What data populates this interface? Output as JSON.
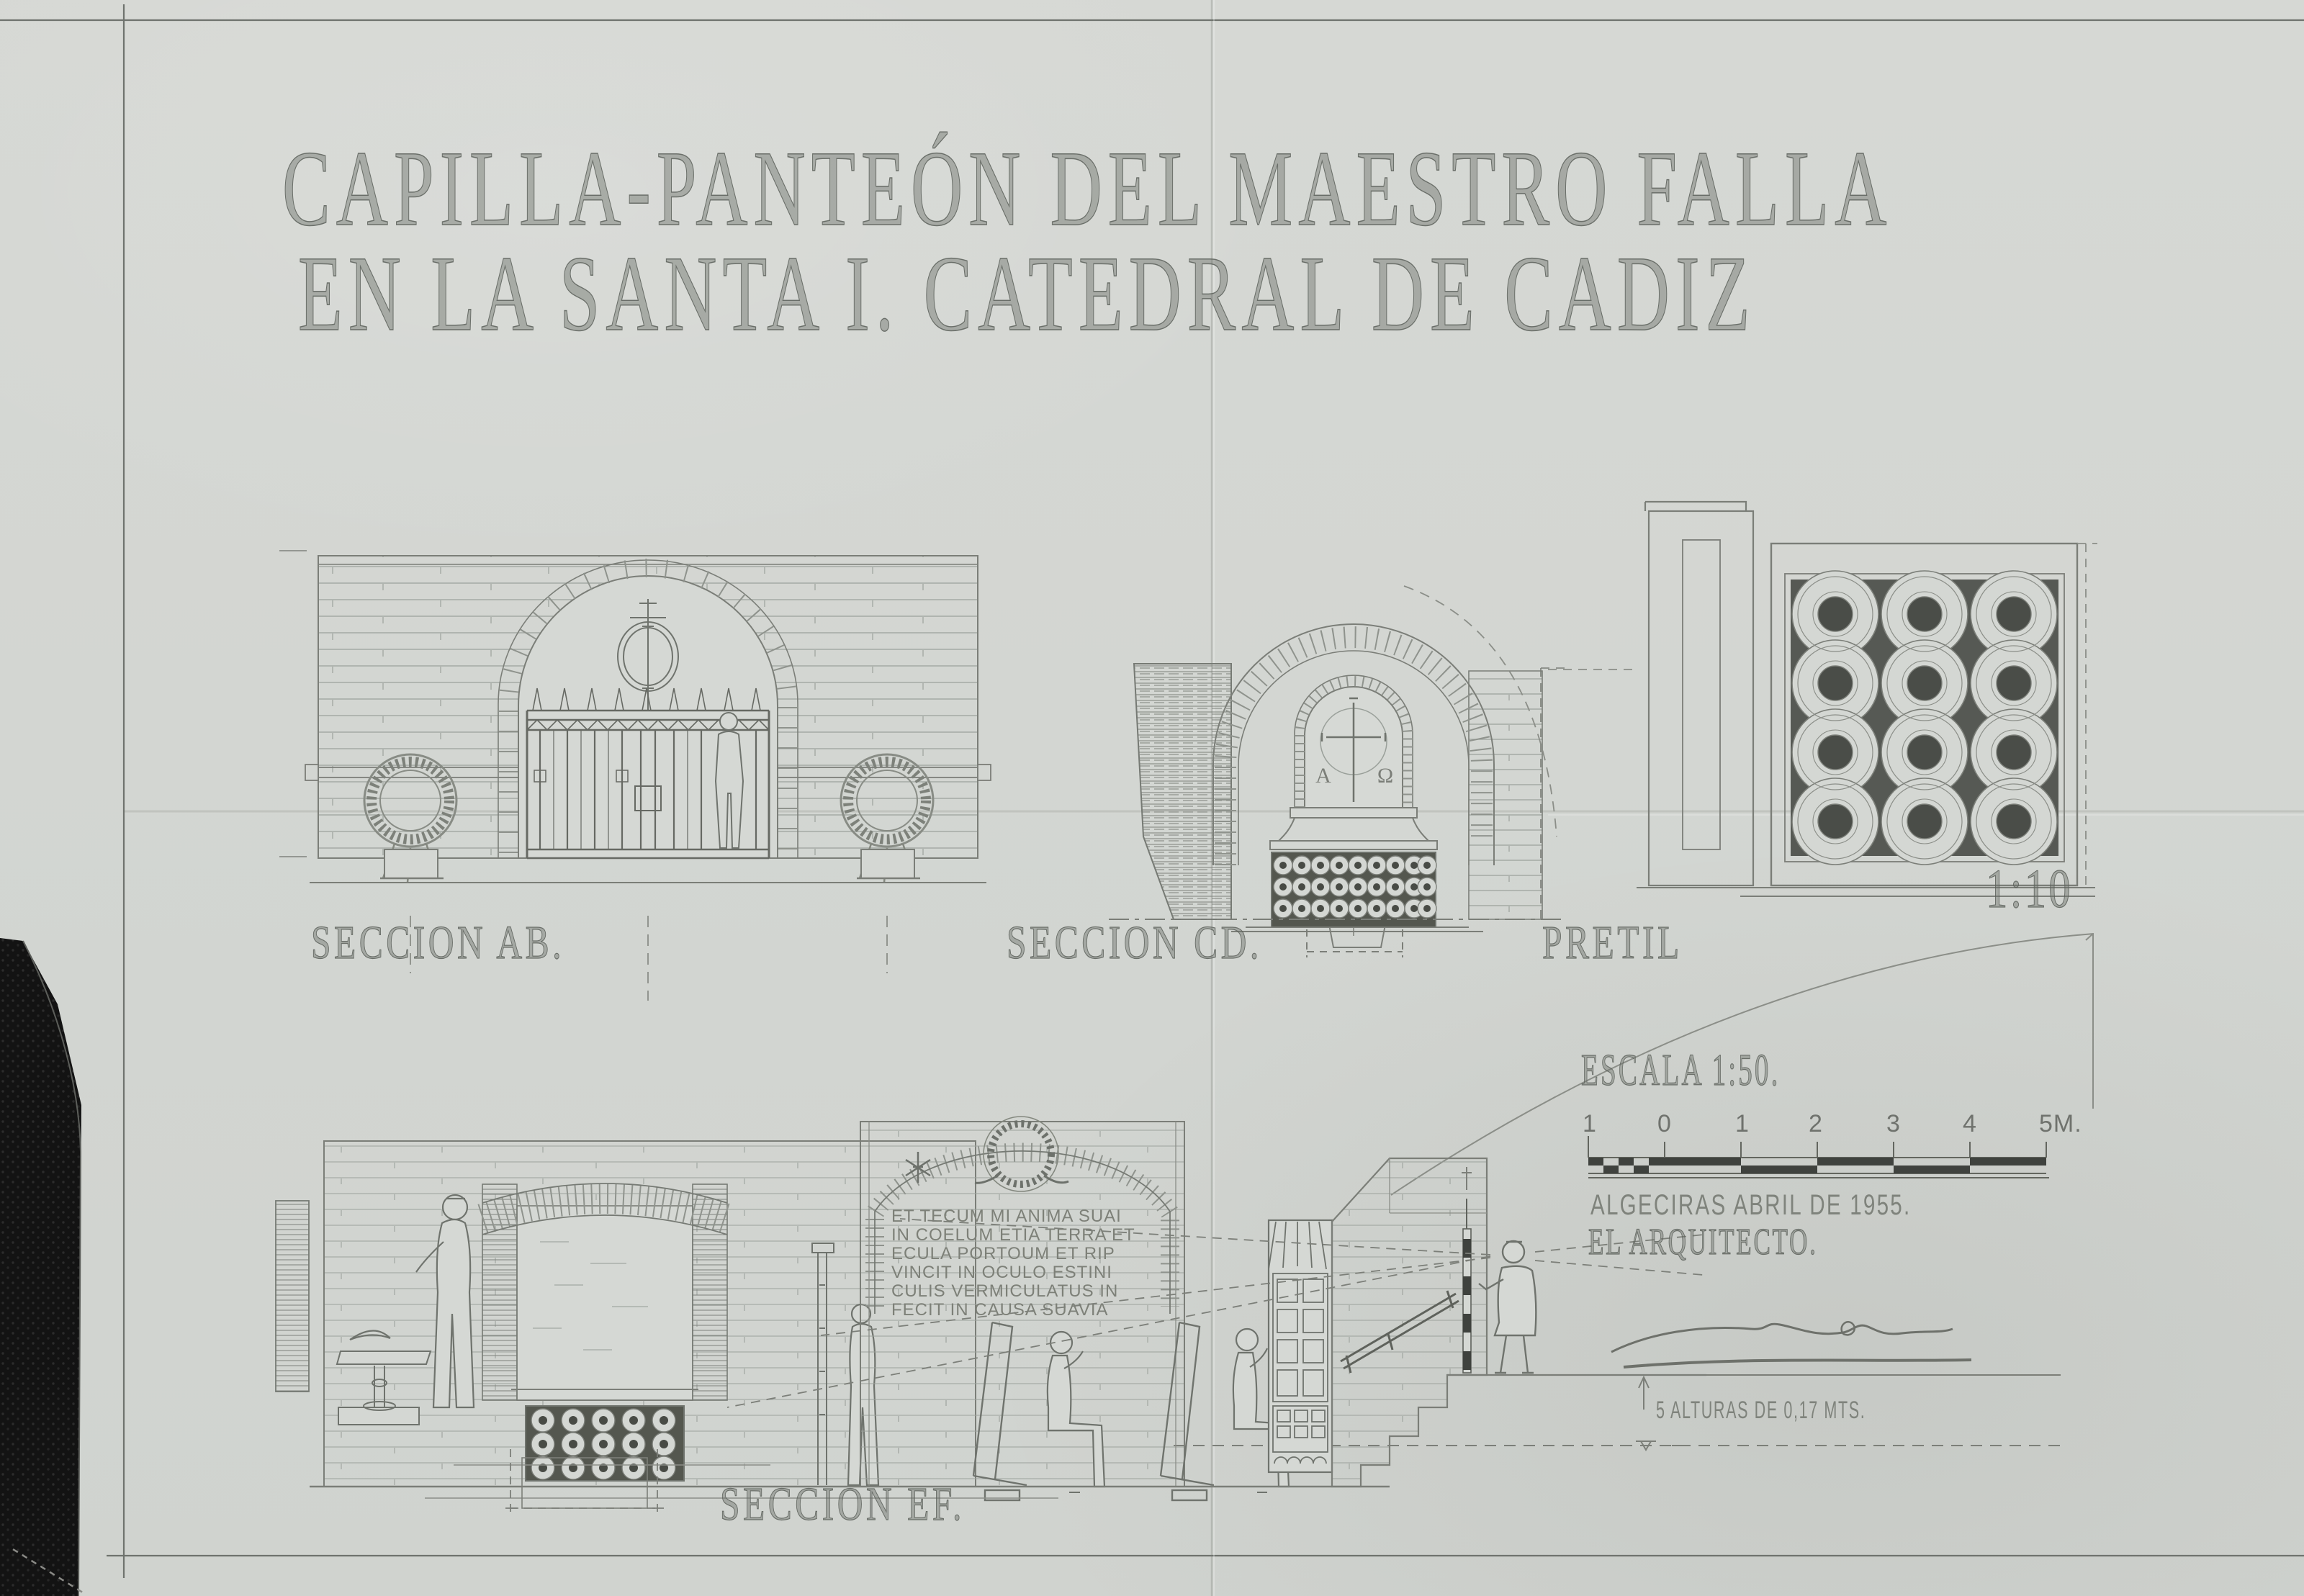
{
  "document": {
    "title_line1": "CAPILLA-PANTEÓN DEL MAESTRO FALLA",
    "title_line2": "EN LA SANTA I. CATEDRAL DE CADIZ"
  },
  "labels": {
    "section_ab": "SECCION AB.",
    "section_cd": "SECCION CD.",
    "pretil": "PRETIL",
    "pretil_scale": "1:10",
    "section_ef": "SECCION EF.",
    "scale_title": "ESCALA 1:50.",
    "scale_ticks": [
      "1",
      "0",
      "1",
      "2",
      "3",
      "4",
      "5M."
    ],
    "place_date": "ALGECIRAS ABRIL DE 1955.",
    "architect": "EL ARQUITECTO.",
    "heights_note": "5 ALTURAS DE 0,17 MTS.",
    "alpha": "Α",
    "omega": "Ω"
  },
  "inscription": {
    "lines": [
      "ET TECUM MI ANIMA SUAI",
      "IN COELUM ETIA TERRA ET",
      "ECULA PORTOUM ET RIP",
      "VINCIT IN OCULO ESTINI",
      "CULIS VERMICULATUS IN",
      "FECIT IN CAUSA SUAVIA"
    ]
  },
  "colors": {
    "paper": "#d3d6d2",
    "ink": "#787b76",
    "ink_light": "#9aa09a",
    "ink_dark": "#40433f",
    "backing_black": "#141414"
  }
}
